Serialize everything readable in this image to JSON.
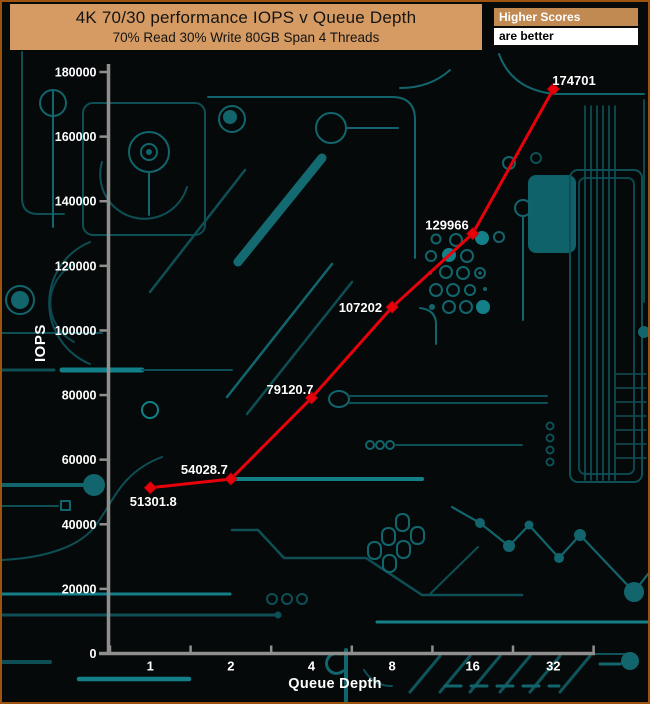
{
  "page": {
    "background": "#060909",
    "border_color": "#9d5410"
  },
  "header": {
    "title": "4K 70/30 performance IOPS v Queue Depth",
    "subtitle": "70% Read 30% Write 80GB Span 4 Threads",
    "bg": "#d59b63",
    "text_color": "#141414"
  },
  "score_note": {
    "line1": "Higher Scores",
    "line2": "are better",
    "line1_bg": "#c08a52",
    "line1_color": "#ffffff",
    "line2_bg": "#ffffff",
    "line2_color": "#000000"
  },
  "chart_data": {
    "type": "line",
    "title": "4K 70/30 performance IOPS v Queue Depth",
    "subtitle": "70% Read 30% Write 80GB Span 4 Threads",
    "xlabel": "Queue Depth",
    "ylabel": "IOPS",
    "categories": [
      "1",
      "2",
      "4",
      "8",
      "16",
      "32"
    ],
    "series": [
      {
        "name": "IOPS",
        "color": "#e8000b",
        "marker": "diamond",
        "values": [
          51301.8,
          54028.7,
          79120.7,
          107202,
          129966,
          174701
        ],
        "point_labels": [
          "51301.8",
          "54028.7",
          "79120.7",
          "107202",
          "129966",
          "174701"
        ]
      }
    ],
    "ylim": [
      0,
      180000
    ],
    "ytick_step": 20000,
    "ytick_labels": [
      "0",
      "20000",
      "40000",
      "60000",
      "80000",
      "100000",
      "120000",
      "140000",
      "160000",
      "180000"
    ],
    "grid": false,
    "legend": "none",
    "axis_color": "#8f8f8f",
    "label_color": "#ffffff",
    "background_theme": "dark-circuit-board",
    "trace_color": "#12656c"
  }
}
